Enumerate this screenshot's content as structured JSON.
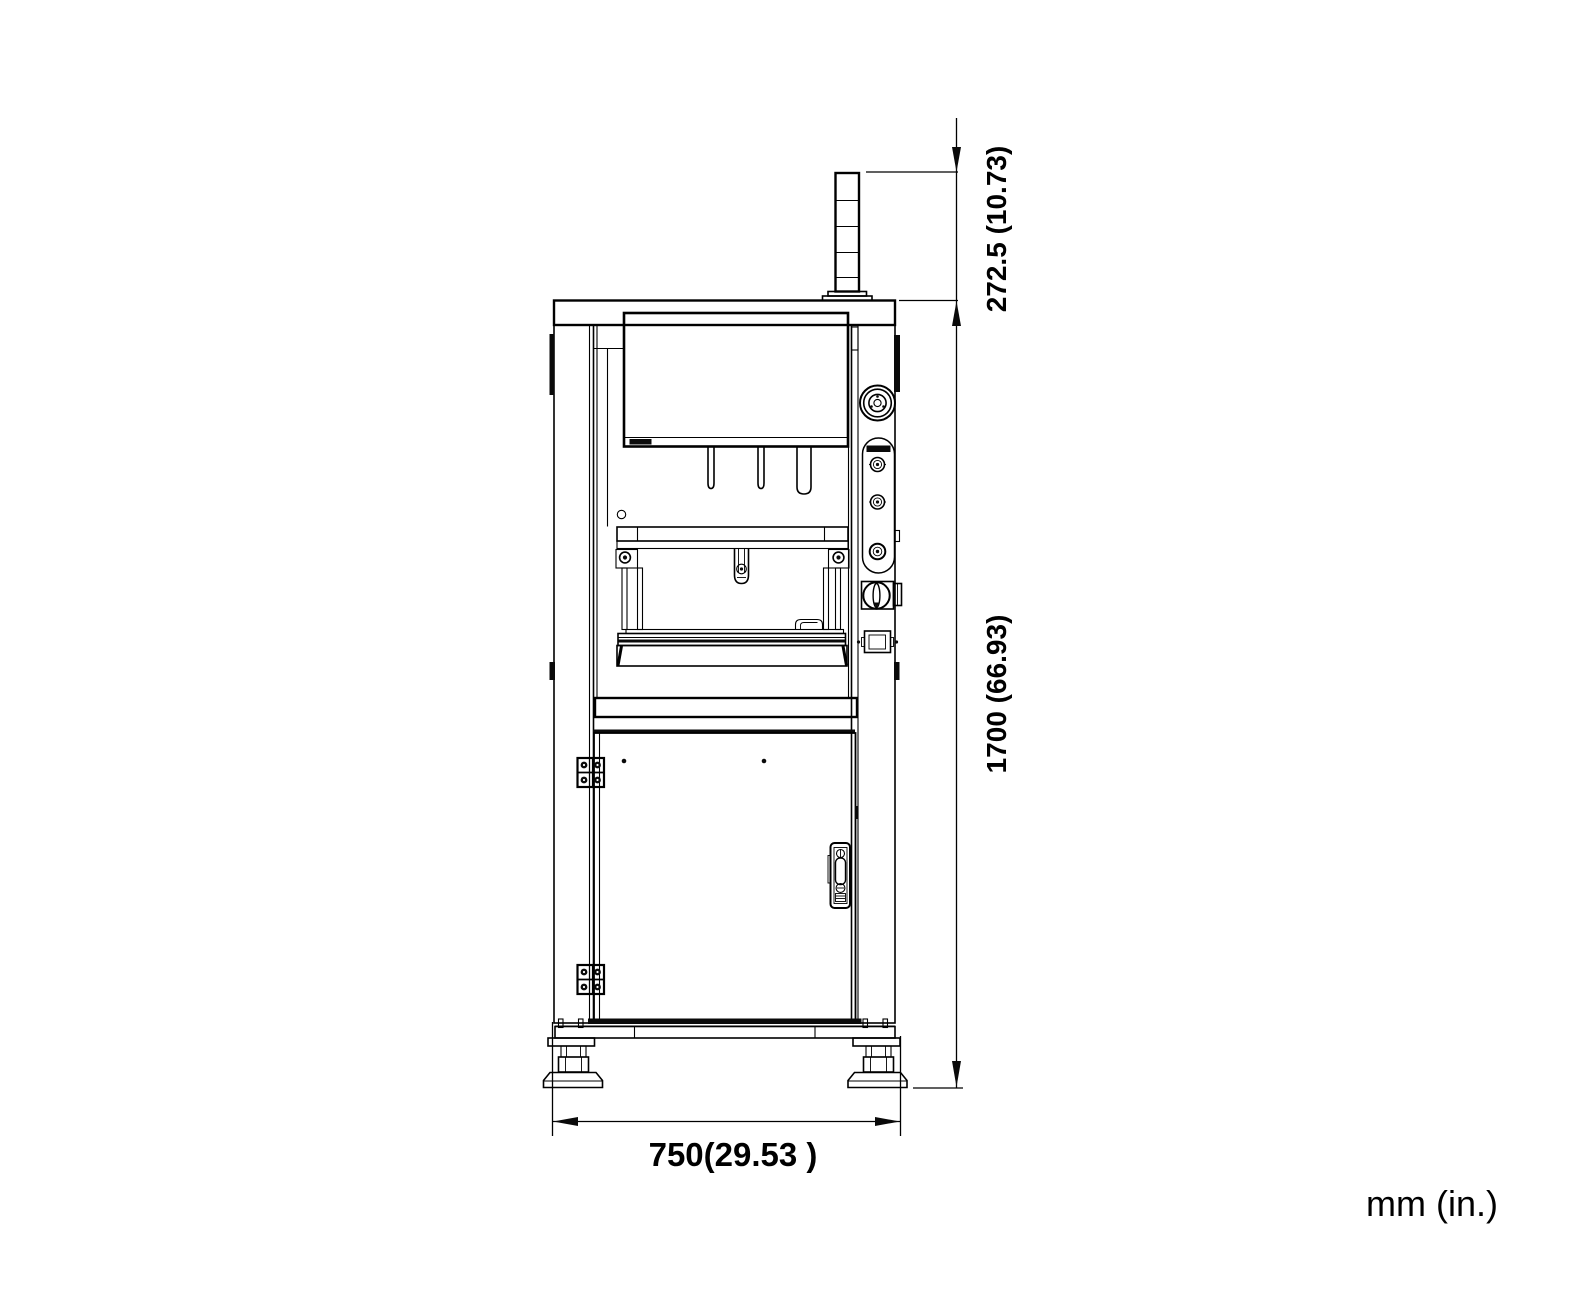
{
  "colors": {
    "line": "#000000",
    "background": "#ffffff"
  },
  "dimensions": [
    {
      "id": "tower-height",
      "text": "272.5 (10.73)",
      "mm": 272.5,
      "inches": 10.73,
      "orientation": "vertical"
    },
    {
      "id": "machine-height",
      "text": "1700 (66.93)",
      "mm": 1700,
      "inches": 66.93,
      "orientation": "vertical"
    },
    {
      "id": "base-width",
      "text": "750(29.53 )",
      "mm": 750,
      "inches": 29.53,
      "orientation": "horizontal"
    }
  ],
  "units_label": "mm (in.)"
}
